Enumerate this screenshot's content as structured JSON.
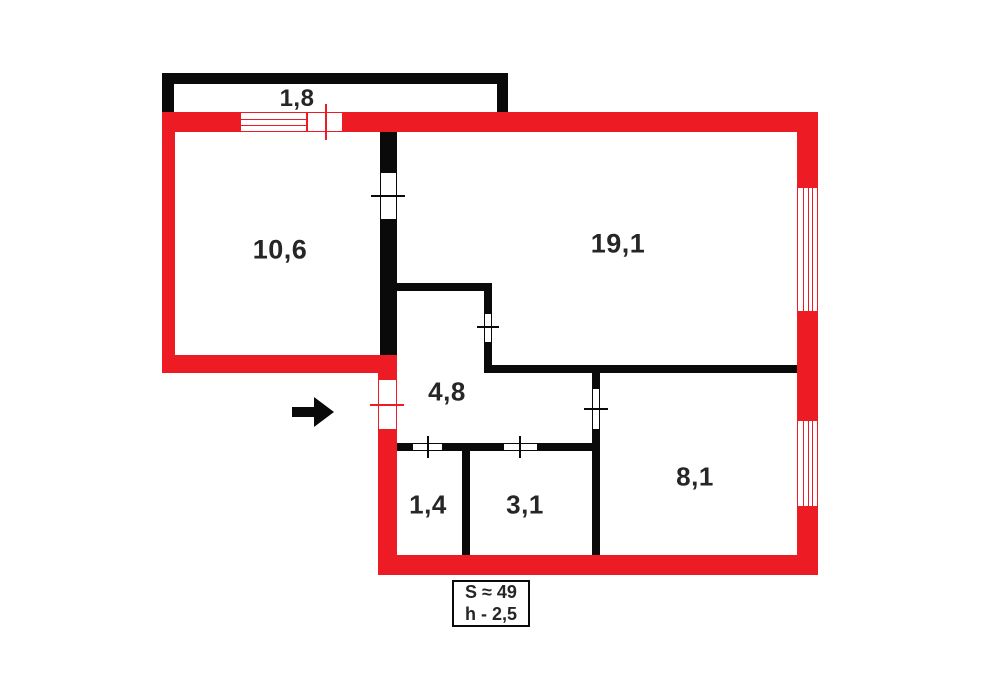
{
  "title": "Apartment floor plan",
  "colors": {
    "exterior_wall": "#ED1C24",
    "interior_wall": "#0A0A0A",
    "label_text": "#262626",
    "background": "#FFFFFF"
  },
  "rooms": [
    {
      "name": "balcony",
      "area": "1,8"
    },
    {
      "name": "room-10-6",
      "area": "10,6"
    },
    {
      "name": "room-19-1",
      "area": "19,1"
    },
    {
      "name": "hall-4-8",
      "area": "4,8"
    },
    {
      "name": "room-1-4",
      "area": "1,4"
    },
    {
      "name": "room-3-1",
      "area": "3,1"
    },
    {
      "name": "room-8-1",
      "area": "8,1"
    }
  ],
  "legend": {
    "total_area": "S ≈ 49",
    "ceiling_height": "h - 2,5"
  },
  "icons": {
    "entrance_arrow": "right-arrow"
  }
}
